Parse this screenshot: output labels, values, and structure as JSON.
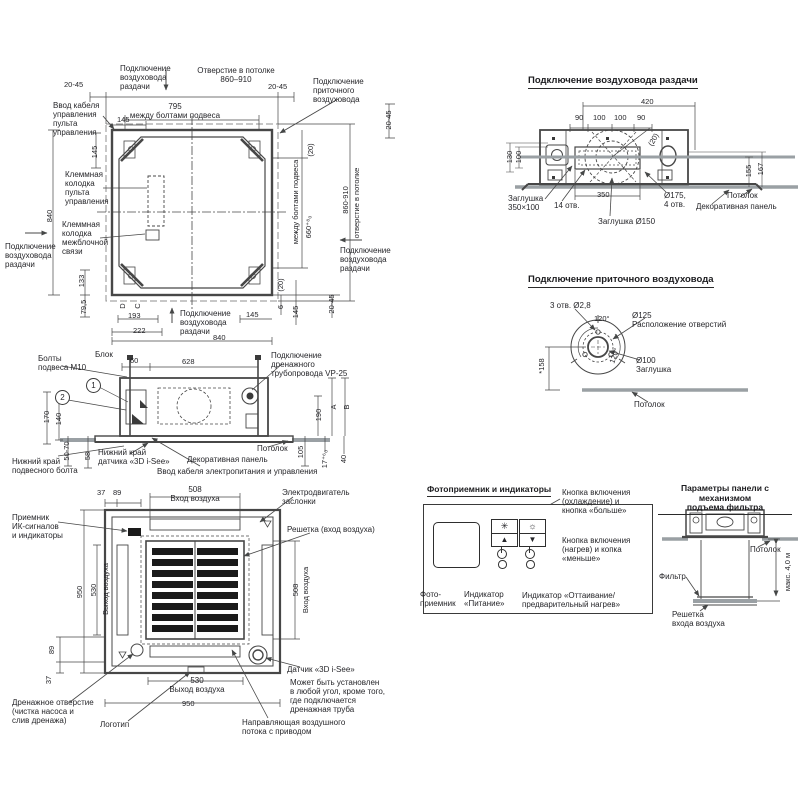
{
  "top_view": {
    "duct_supply_top": "Подключение\nвоздуховода\nраздачи",
    "ceiling_opening_top": "Отверстие в потолке\n860–910",
    "gap_top_left": "20-45",
    "gap_top_right": "20-45",
    "fresh_air_conn": "Подключение\nприточного\nвоздуховода",
    "control_cable_entry": "Ввод кабеля\nуправления\nпульта\nуправления",
    "bolt_pitch": "795\nмежду болтами подвеса",
    "dim_145_top": "145",
    "dim_145_left": "145",
    "terminal_block_remote": "Клеммная\nколодка\nпульта\nуправления",
    "dim_840_left": "840",
    "terminal_block_inter": "Клеммная\nколодка\nмежблочной\nсвязи",
    "duct_supply_left": "Подключение\nвоздуховода\nраздачи",
    "dim_133": "133",
    "dim_79_5": "79,5",
    "mark_d": "D",
    "mark_c": "C",
    "dim_193": "193",
    "dim_222": "222",
    "duct_supply_bottom": "Подключение\nвоздуховода\nраздачи",
    "dim_145_bottom": "145",
    "dim_840_bottom": "840",
    "paren_20_top": "(20)",
    "paren_20_bottom": "(20)",
    "dim_6": "6",
    "dim_145_right": "145",
    "bolt_pitch_right": "между болтами подвеса",
    "dim_660": "660⁺⁸₀",
    "dim_860_910_right": "860-910",
    "ceiling_opening_right": "отверстие в потолке",
    "gap_right_top": "20-45",
    "gap_right_bottom": "20-45",
    "duct_supply_right": "Подключение\nвоздуховода\nраздачи"
  },
  "duct_view": {
    "title": "Подключение воздуховода раздачи",
    "dim_420": "420",
    "dim_90a": "90",
    "dim_100a": "100",
    "dim_100b": "100",
    "dim_90b": "90",
    "dim_130": "130",
    "dim_100_left": "100",
    "dim_155": "155",
    "dim_167": "167",
    "dim_350": "350",
    "paren_20": "(20)",
    "plug_350x100": "Заглушка\n350×100",
    "holes_14": "14 отв.",
    "d175_4holes": "Ø175,\n4 отв.",
    "plug_d150": "Заглушка Ø150",
    "ceiling": "Потолок",
    "decor_panel": "Декоративная панель"
  },
  "fresh_view": {
    "title": "Подключение приточного воздуховода",
    "holes_3_d28": "3 отв. Ø2,8",
    "angle_120a": "120°",
    "angle_120b": "120°",
    "d125": "Ø125\nРасположение отверстий",
    "d100": "Ø100\nЗаглушка",
    "dim_158": "*158",
    "ceiling": "Потолок"
  },
  "side_view": {
    "bolts_m10": "Болты\nподвеса М10",
    "unit": "Блок",
    "dim_60": "60",
    "dim_628": "628",
    "drain": "Подключение\nдренажного\nтрубопровода VP-25",
    "callout_1": "1",
    "callout_2": "2",
    "dim_170": "170",
    "dim_140": "140",
    "dim_50_70": "50-70",
    "dim_58": "58",
    "lower_edge_bolt": "Нижний край\nподвесного болта",
    "lower_edge_sensor": "Нижний край\nдатчика «3D i-See»",
    "decor_panel": "Декоративная панель",
    "ceiling": "Потолок",
    "power_cable": "Ввод кабеля электропитания и управления",
    "dim_190": "190",
    "dim_105": "105",
    "dim_a": "A",
    "dim_b": "B",
    "dim_17": "17⁺⁶₀",
    "dim_40": "40"
  },
  "bottom_view": {
    "dim_37_top": "37",
    "dim_89_top": "89",
    "inlet_top": "508\nВход воздуха",
    "damper_motor": "Электродвигатель\nзаслонки",
    "ir_receiver": "Приемник\nИК-сигналов\nи индикаторы",
    "grille_inlet": "Решетка (вход воздуха)",
    "dim_950_left": "950",
    "dim_530_left": "530",
    "outlet_left": "Выход воздуха",
    "dim_508_right": "508",
    "inlet_right": "Вход воздуха",
    "dim_89_bottom": "89",
    "dim_37_bottom": "37",
    "outlet_bottom": "530\nВыход воздуха",
    "dim_950_bottom": "950",
    "drain_hole": "Дренажное отверстие\n(чистка насоса и\nслив дренажа)",
    "logo": "Логотип",
    "sensor_3d": "Датчик «3D i-See»",
    "sensor_note": "Может быть установлен\nв любой угол, кроме того,\nгде подключается\nдренажная труба",
    "vane": "Направляющая воздушного\nпотока с приводом"
  },
  "photo_box": {
    "title": "Фотоприемник и индикаторы",
    "btn_cool": "Кнопка включения\n(охлаждение) и\nкнопка «больше»",
    "btn_heat": "Кнопка включения\n(нагрев) и копка\n«меньше»",
    "photo_receiver": "Фото-\nприемник",
    "ind_power": "Индикатор\n«Питание»",
    "ind_defrost": "Индикатор «Оттаивание/\nпредварительный нагрев»",
    "icons": {
      "cool": "✳",
      "heat": "☼",
      "up": "▲",
      "down": "▼"
    }
  },
  "panel_view": {
    "title": "Параметры панели с механизмом\nподъема фильтра",
    "ceiling": "Потолок",
    "filter": "Фильтр",
    "grille": "Решетка\nвхода воздуха",
    "max_4m": "макс. 4,0 м"
  }
}
